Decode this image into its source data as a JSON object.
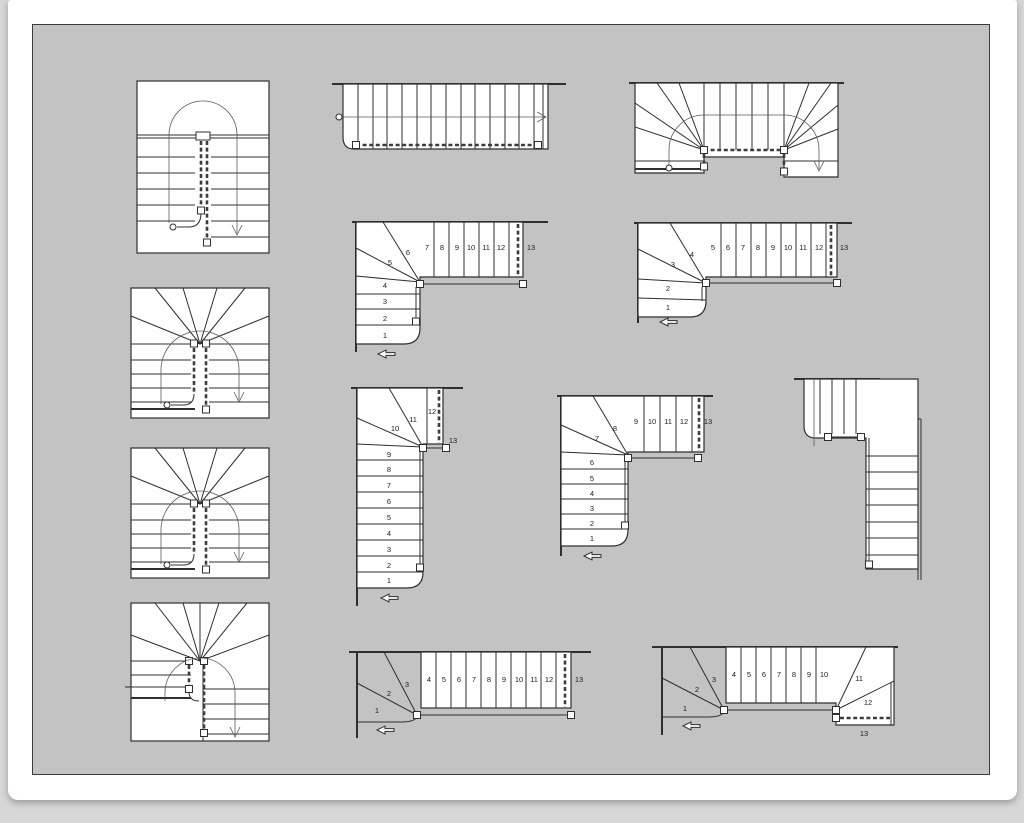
{
  "colors": {
    "outer_bg": "#d7d7d7",
    "sheet_bg": "#ffffff",
    "canvas_bg": "#c3c3c3",
    "line": "#2f2f2f"
  },
  "diagrams": {
    "L13a": {
      "steps": [
        "1",
        "2",
        "3",
        "4",
        "5",
        "6",
        "7",
        "8",
        "9",
        "10",
        "11",
        "12",
        "13"
      ]
    },
    "L13b": {
      "steps": [
        "1",
        "2",
        "3",
        "4",
        "5",
        "6",
        "7",
        "8",
        "9",
        "10",
        "11",
        "12",
        "13"
      ]
    },
    "L13c": {
      "steps": [
        "1",
        "2",
        "3",
        "4",
        "5",
        "6",
        "7",
        "8",
        "9",
        "10",
        "11",
        "12",
        "13"
      ]
    },
    "L13d": {
      "steps": [
        "1",
        "2",
        "3",
        "4",
        "5",
        "6",
        "7",
        "8",
        "9",
        "10",
        "11",
        "12",
        "13"
      ]
    },
    "W13a": {
      "steps": [
        "1",
        "2",
        "3",
        "4",
        "5",
        "6",
        "7",
        "8",
        "9",
        "10",
        "11",
        "12",
        "13"
      ]
    },
    "W13b": {
      "steps": [
        "1",
        "2",
        "3",
        "4",
        "5",
        "6",
        "7",
        "8",
        "9",
        "10",
        "11",
        "12",
        "13"
      ]
    }
  }
}
